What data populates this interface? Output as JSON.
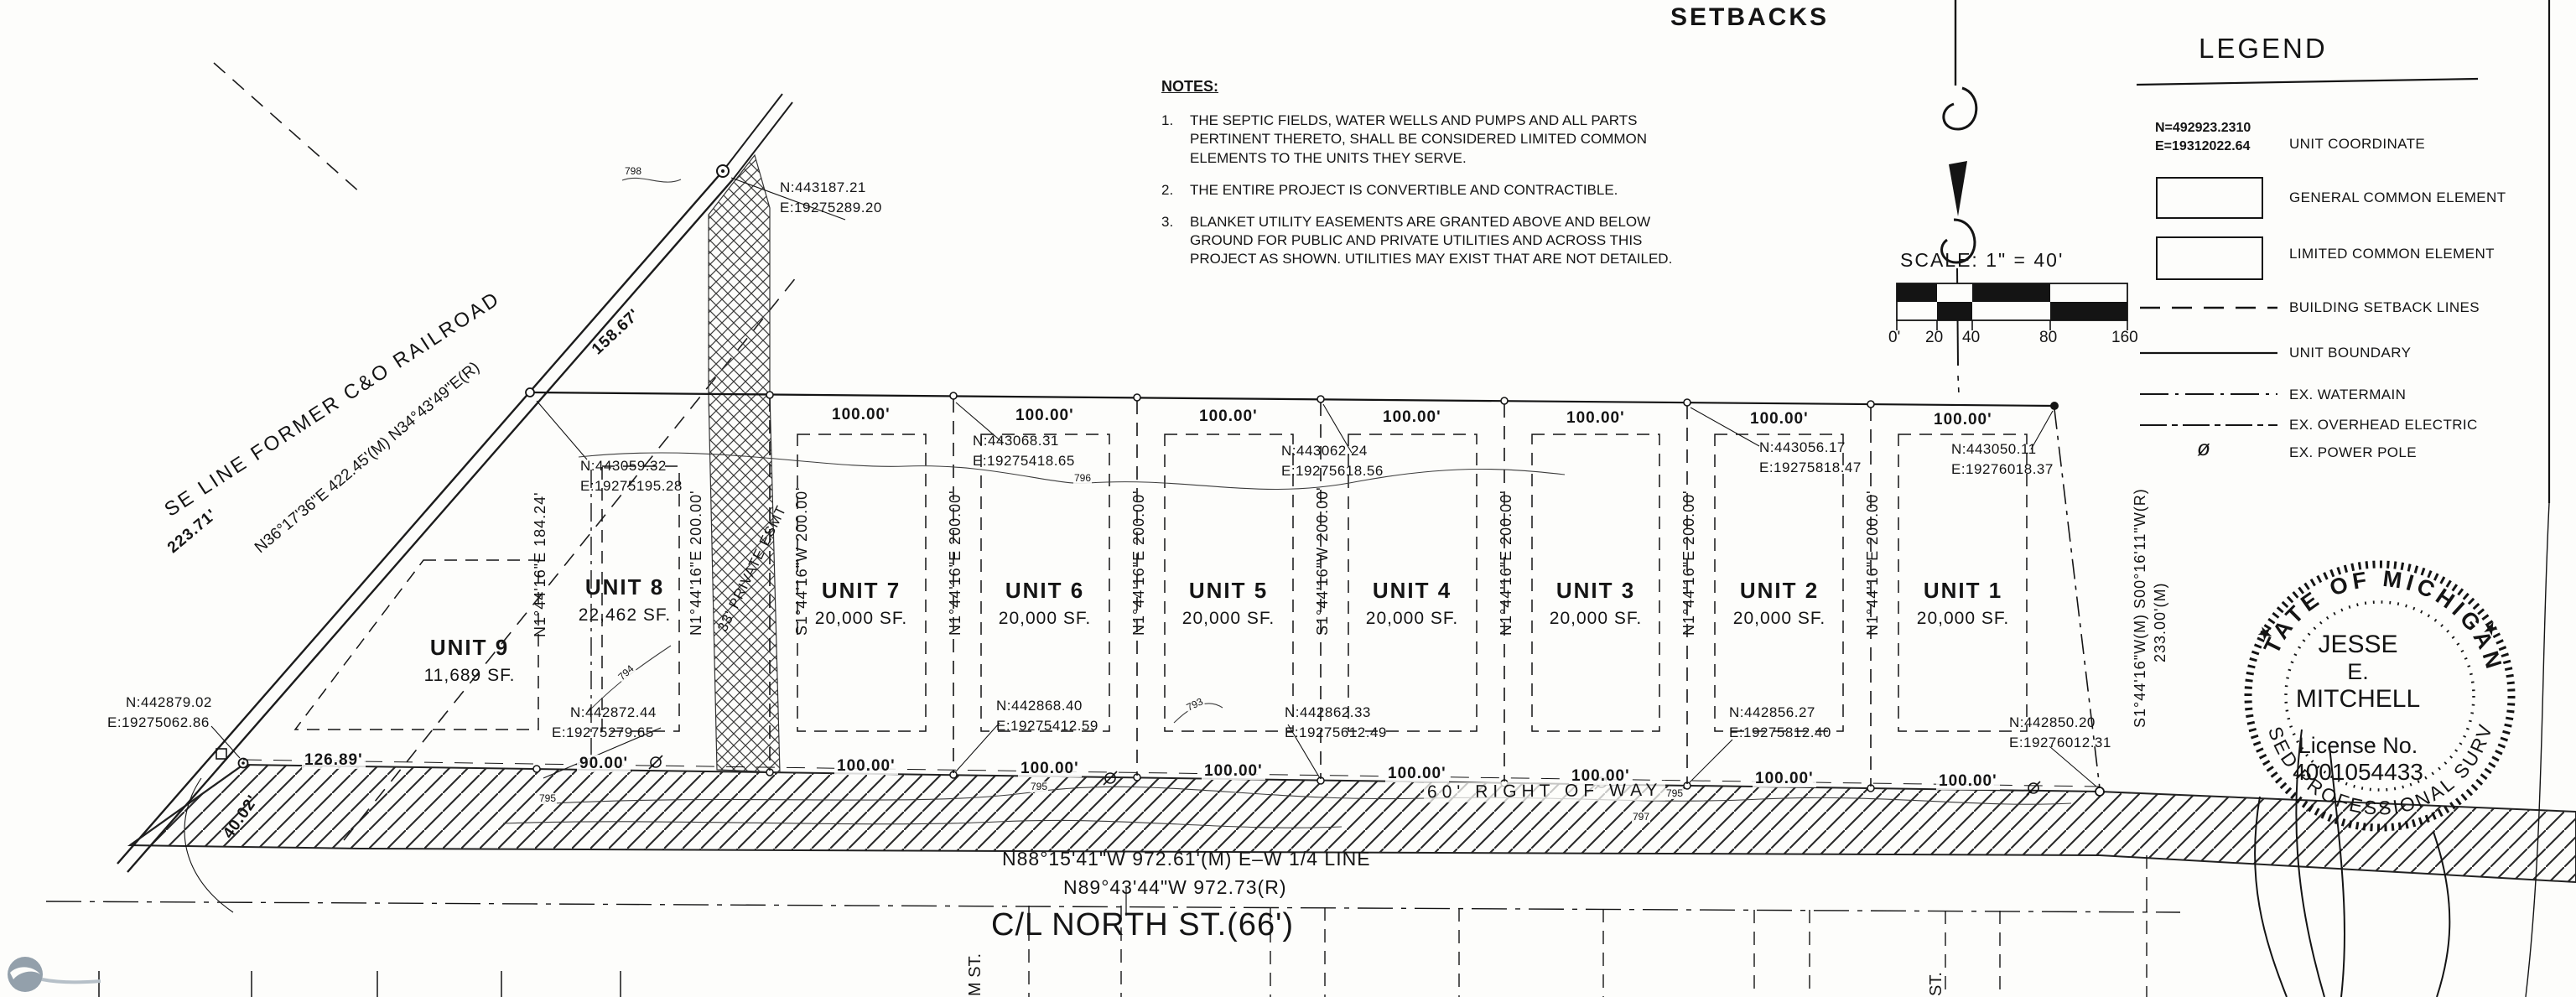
{
  "page": {
    "heading": "SETBACKS"
  },
  "notes": {
    "title": "NOTES:",
    "item1_num": "1.",
    "item1": "THE SEPTIC FIELDS, WATER WELLS AND PUMPS AND ALL PARTS PERTINENT THERETO, SHALL BE CONSIDERED LIMITED COMMON ELEMENTS TO THE UNITS THEY SERVE.",
    "item2_num": "2.",
    "item2": "THE ENTIRE PROJECT IS CONVERTIBLE AND CONTRACTIBLE.",
    "item3_num": "3.",
    "item3": "BLANKET UTILITY EASEMENTS ARE GRANTED ABOVE AND BELOW GROUND FOR PUBLIC AND PRIVATE UTILITIES AND ACROSS THIS PROJECT AS SHOWN. UTILITIES MAY EXIST THAT ARE NOT DETAILED."
  },
  "scale": {
    "label": "SCALE:   1\" = 40'",
    "tick0": "0'",
    "tick20": "20",
    "tick40": "40",
    "tick80": "80",
    "tick160": "160"
  },
  "legend": {
    "title": "LEGEND",
    "sample_n": "N=492923.2310",
    "sample_e": "E=19312022.64",
    "row_unit_coordinate": "UNIT COORDINATE",
    "row_general_common": "GENERAL COMMON ELEMENT",
    "row_limited_common": "LIMITED COMMON ELEMENT",
    "row_setback_lines": "BUILDING SETBACK LINES",
    "row_unit_boundary": "UNIT BOUNDARY",
    "row_watermain": "EX. WATERMAIN",
    "row_overhead_electric": "EX. OVERHEAD ELECTRIC",
    "row_power_pole": "EX. POWER POLE",
    "pole_symbol": "ø"
  },
  "units": {
    "u9": {
      "name": "UNIT 9",
      "area": "11,689 SF."
    },
    "u8": {
      "name": "UNIT 8",
      "area": "22,462 SF."
    },
    "u7": {
      "name": "UNIT 7",
      "area": "20,000 SF."
    },
    "u6": {
      "name": "UNIT 6",
      "area": "20,000 SF."
    },
    "u5": {
      "name": "UNIT 5",
      "area": "20,000 SF."
    },
    "u4": {
      "name": "UNIT 4",
      "area": "20,000 SF."
    },
    "u3": {
      "name": "UNIT 3",
      "area": "20,000 SF."
    },
    "u2": {
      "name": "UNIT 2",
      "area": "20,000 SF."
    },
    "u1": {
      "name": "UNIT 1",
      "area": "20,000 SF."
    }
  },
  "dims": {
    "d100": "100.00'",
    "d126": "126.89'",
    "d90": "90.00'",
    "d158": "158.67'",
    "d223": "223.71'",
    "d40": "40.02'",
    "v184": "N1°44'16\"E 184.24'",
    "v200n": "N1°44'16\"E 200.00'",
    "v200s": "S1°44'16\"W 200.00'",
    "right_line1": "S1°44'16\"W(M) S00°16'11\"W(R)",
    "right_line2": "233.00'(M)"
  },
  "coords": {
    "rr_n": "N:443187.21",
    "rr_e": "E:19275289.20",
    "t8_n": "N:443059.32",
    "t8_e": "E:19275195.28",
    "t6_n": "N:443068.31",
    "t6_e": "E:19275418.65",
    "t4_n": "N:443062.24",
    "t4_e": "E:19275618.56",
    "t2_n": "N:443056.17",
    "t2_e": "E:19275818.47",
    "t1_n": "N:443050.11",
    "t1_e": "E:19276018.37",
    "b9_n": "N:442879.02",
    "b9_e": "E:19275062.86",
    "b8_n": "N:442872.44",
    "b8_e": "E:19275279.65",
    "b6_n": "N:442868.40",
    "b6_e": "E:19275412.59",
    "b4_n": "N:442862.33",
    "b4_e": "E:19275612.49",
    "b2_n": "N:442856.27",
    "b2_e": "E:19275812.40",
    "b1_n": "N:442850.20",
    "b1_e": "E:19276012.31"
  },
  "railroad": {
    "name": "SE LINE FORMER C&O RAILROAD",
    "bearing": "N36°17'36\"E 422.45'(M) N34°43'49\"E(R)"
  },
  "easement": {
    "label": "33' PRIVATE ESMT"
  },
  "road": {
    "right_of_way": "60' RIGHT OF WAY",
    "quarter_line_m": "N88°15'41\"W 972.61'(M) E–W 1/4 LINE",
    "quarter_line_r": "N89°43'44\"W 972.73(R)",
    "centerline": "C/L NORTH ST.(66')"
  },
  "streets": {
    "left_vertical": "M ST.",
    "right_vertical": "ST."
  },
  "contours": {
    "c793": "793",
    "c794": "794",
    "c795": "795",
    "c796": "796",
    "c797": "797",
    "c798": "798"
  },
  "seal": {
    "arc_top": "STATE OF MICHIGAN",
    "arc_bottom": "LICENSED PROFESSIONAL SURVEYOR",
    "star": "★",
    "name1": "JESSE",
    "name2": "E.",
    "name3": "MITCHELL",
    "lic1": "License No.",
    "lic2": "4001054433"
  }
}
